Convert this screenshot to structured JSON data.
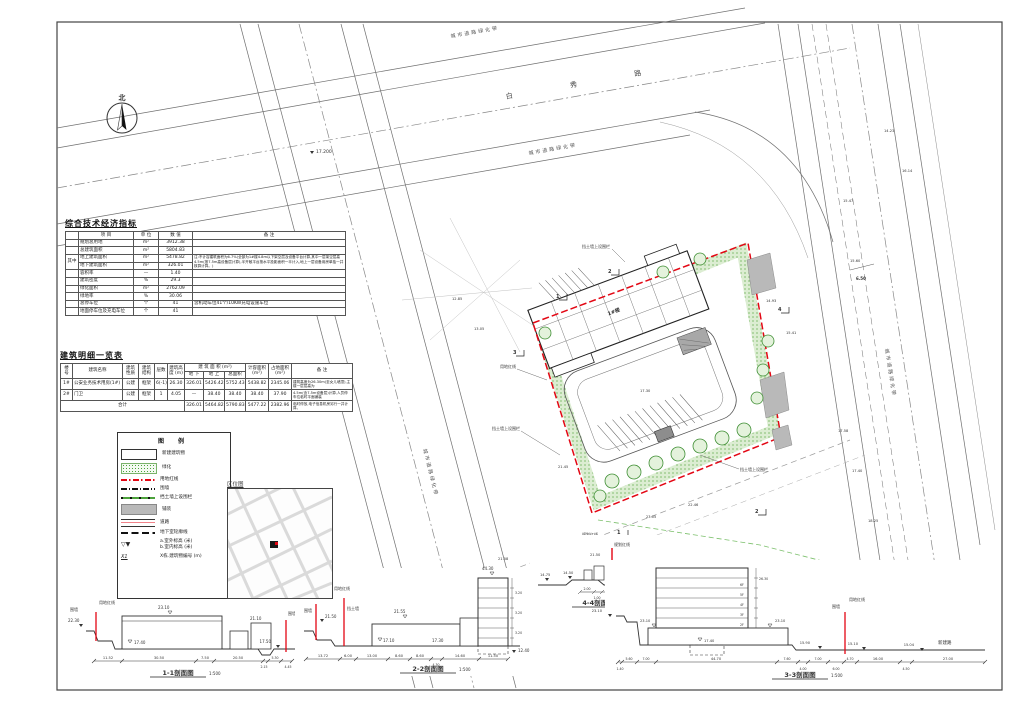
{
  "colors": {
    "red": "#e30613",
    "green": "#4ca23b",
    "green_fill": "#ddeed3",
    "gray_fill": "#b9b9b9"
  },
  "north_label": "北",
  "roads": {
    "top_name": "白 秀 路",
    "belt": "城市道路绿化带",
    "junction_elev": "17.200",
    "right_dim": "6.50",
    "spot_elevs": [
      "15.47",
      "15.60",
      "17.58",
      "17.40",
      "18.25",
      "14.23",
      "16.14"
    ]
  },
  "site": {
    "red_line_label": "用地红线",
    "plan_line_label": "规划红线",
    "retaining_label": "挡土墙上设围栏",
    "building1_label": "1#楼",
    "spot_elevs": [
      "17.30",
      "21.45",
      "23.05",
      "22.46",
      "15.41",
      "14.93",
      "13.05",
      "12.85",
      "21.86",
      "21.58"
    ],
    "markers": {
      "m1": "1",
      "m2": "2",
      "m3": "3",
      "m4": "4"
    }
  },
  "indicators": {
    "title": "综合技术经济指标",
    "col_item": "项 目",
    "col_unit": "单 位",
    "col_value": "数 值",
    "col_remark": "备 注",
    "group": "其中",
    "rows": [
      {
        "item": "规划总用地",
        "unit": "m²",
        "value": "3912.38",
        "remark": ""
      },
      {
        "item": "总建筑面积",
        "unit": "m²",
        "value": "5804.83",
        "remark": ""
      },
      {
        "item": "地上建筑面积",
        "unit": "m²",
        "value": "5478.82",
        "remark": "注:不计容建筑面积为6.7%(全部为1#楼4.8m以下架空层及设备平台计算,其中一层架空层高4.5m(按7.5m高设备层计算),半开敞平台按水平投影面积一半计入,地上一层设备用房单独一并核算计算。)"
      },
      {
        "item": "地下建筑面积",
        "unit": "m²",
        "value": "326.01",
        "remark": ""
      },
      {
        "item": "容积率",
        "unit": "—",
        "value": "1.40",
        "remark": ""
      },
      {
        "item": "建筑密度",
        "unit": "%",
        "value": "29.3",
        "remark": ""
      },
      {
        "item": "绿化面积",
        "unit": "m²",
        "value": "2762.09",
        "remark": ""
      },
      {
        "item": "绿地率",
        "unit": "%",
        "value": "30.06",
        "remark": ""
      },
      {
        "item": "总停车位",
        "unit": "个",
        "value": "41",
        "remark": "含机动车位41个/10KW充电设施车位"
      },
      {
        "item": "地面停车位及充电车位",
        "unit": "个",
        "value": "41",
        "remark": ""
      }
    ]
  },
  "buildings": {
    "title": "建筑明细一览表",
    "h_no": "楼 号",
    "h_name": "建筑名称",
    "h_nature": "建筑性质",
    "h_struct": "建筑结构",
    "h_floors": "层数",
    "h_height": "建筑高度 (m)",
    "h_area": "建 筑 面 积 (m²)",
    "h_below": "地 下",
    "h_above": "地 上",
    "h_total": "总面积",
    "h_cap": "计容面积 (m²)",
    "h_foot": "占地面积 (m²)",
    "h_remark": "备 注",
    "rows": [
      {
        "no": "1#",
        "name": "公安业务技术用房(1#)",
        "nature": "公建",
        "structure": "框架",
        "floors": "6(-1)",
        "height": "26.30",
        "below": "326.01",
        "above": "5426.42",
        "total": "5752.43",
        "cap": "5438.82",
        "foot": "2345.06",
        "remark": "建筑高度为26.30m(至女儿墙顶),主楼一层层高为"
      },
      {
        "no": "2#",
        "name": "门卫",
        "nature": "公建",
        "structure": "框架",
        "floors": "1",
        "height": "4.05",
        "below": "—",
        "above": "38.40",
        "total": "38.40",
        "cap": "38.40",
        "foot": "37.90",
        "remark": "4.5m(含7.5m设备层)计算,人员停车位临时平面铺装"
      },
      {
        "no": "合计",
        "name": "",
        "nature": "",
        "structure": "",
        "floors": "",
        "height": "",
        "below": "326.01",
        "above": "5464.82",
        "total": "5790.83",
        "cap": "5477.22",
        "foot": "2382.96",
        "remark": "临时停放,电子信息机房另行一并计算。"
      }
    ]
  },
  "legend": {
    "title": "图  例",
    "items": [
      "新建建筑物",
      "绿化",
      "用地红线",
      "围墙",
      "挡土墙上设围栏",
      "铺装",
      "道路",
      "地下室轮廓线"
    ],
    "elev_a": "a.室外标高 (米)",
    "elev_b": "b.室内标高 (米)",
    "bno_sym": "X1",
    "bno_label": "X栋.建筑物编号 (m)"
  },
  "location_map": {
    "title": "区位图"
  },
  "sections": [
    {
      "title": "1-1剖面图",
      "scale": "1:500",
      "dims": [
        "11.52",
        "30.50",
        "7.50",
        "20.50",
        "2.15",
        "5.30",
        "4.45"
      ],
      "e_left": "22.30",
      "e_roof": "23.10",
      "e_ground": "17.40",
      "e_roof2": "21.10",
      "e_right": "17.50",
      "lbl_wall": "围墙",
      "lbl_red": "用地红线"
    },
    {
      "title": "2-2剖面图",
      "scale": "1:500",
      "dims": [
        "13.72",
        "6.00",
        "13.00",
        "8.60",
        "8.60",
        "4.30",
        "14.60",
        "11.50"
      ],
      "e_top": "44.30",
      "e_roof": "21.55",
      "e_g1": "17.10",
      "e_g2": "17.30",
      "e_base": "12.40",
      "e_l1": "21.50",
      "storey": "3.20",
      "lbl_red": "用地红线",
      "lbl_wall": "围墙",
      "lbl_ret": "挡土墙"
    },
    {
      "title": "3-3剖面图",
      "scale": "1:500",
      "dims": [
        "1.40",
        "5.60",
        "7.00",
        "44.70",
        "7.60",
        "4.00",
        "7.00",
        "6.00",
        "4.70",
        "16.00",
        "4.50",
        "27.00"
      ],
      "e_l": "23.10",
      "e_roof": "23.10",
      "e_g": "17.40",
      "e_r1": "15.90",
      "e_r2": "15.10",
      "e_r3": "15.04",
      "total_h": "26.30",
      "floors": [
        "2F",
        "3F",
        "4F",
        "5F",
        "6F"
      ],
      "lbl_wall": "围墙",
      "lbl_red": "用地红线",
      "lbl_road": "新建路"
    },
    {
      "title": "4-4剖面图",
      "scale": "1:500",
      "dims": [
        "2.00",
        "1.00",
        "4.40",
        "2.00"
      ],
      "e_1": "14.75",
      "e_2": "14.50",
      "e_3": "15.40",
      "e_4": "21.50",
      "lbl_red": "规划红线"
    }
  ]
}
